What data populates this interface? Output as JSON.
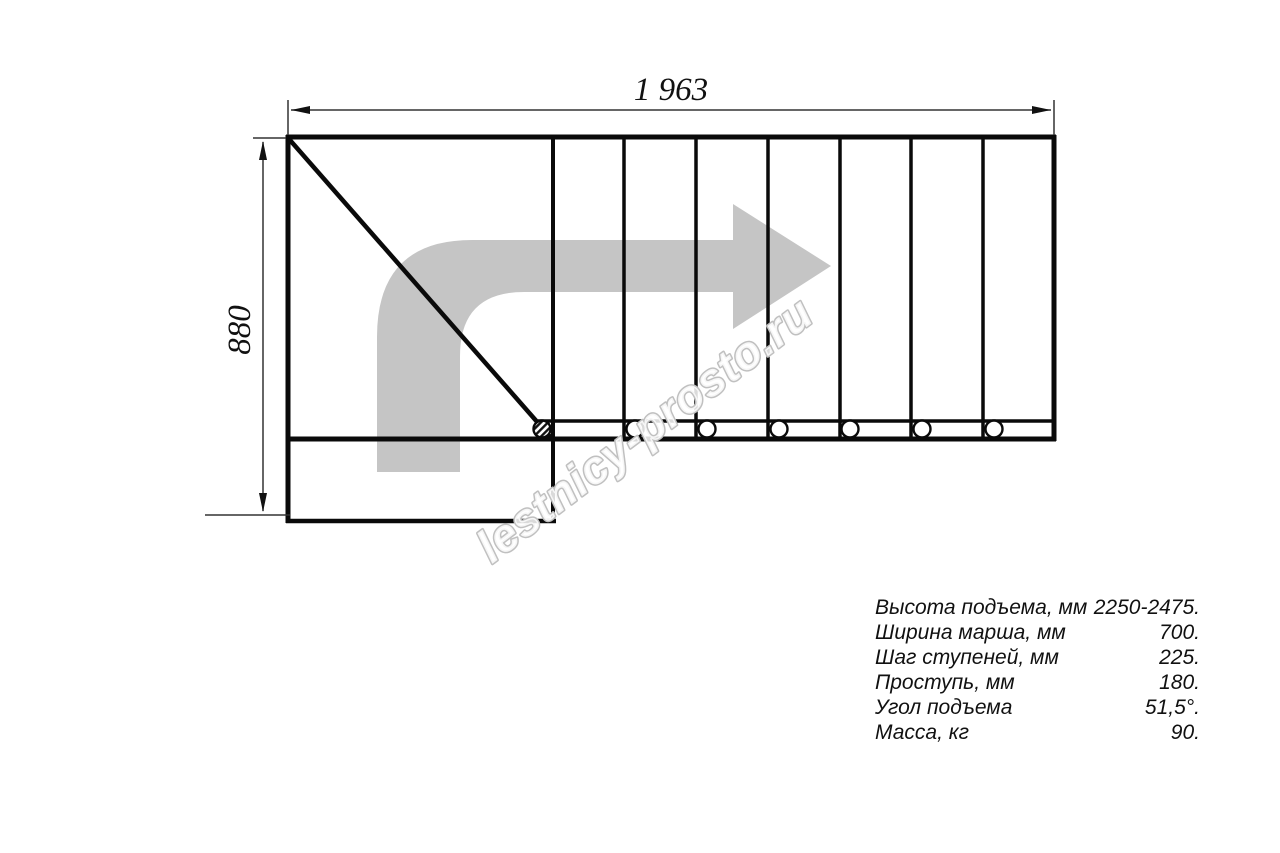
{
  "watermark": {
    "text": "lestnicy-prosto.ru"
  },
  "drawing": {
    "width_label": "1 963",
    "height_label": "880"
  },
  "specs": {
    "rows": [
      {
        "label": "Высота подъема, мм",
        "value": "2250-2475."
      },
      {
        "label": "Ширина марша, мм",
        "value": "700."
      },
      {
        "label": "Шаг ступеней, мм",
        "value": "225."
      },
      {
        "label": "Проступь, мм",
        "value": "180."
      },
      {
        "label": "Угол подъема",
        "value": "51,5°."
      },
      {
        "label": "Масса, кг",
        "value": "90."
      }
    ]
  },
  "colors": {
    "line": "#0a0a0a",
    "dimension": "#333333",
    "arrow_gray": "#c5c5c5",
    "watermark_gray": "#c0c0c0"
  }
}
